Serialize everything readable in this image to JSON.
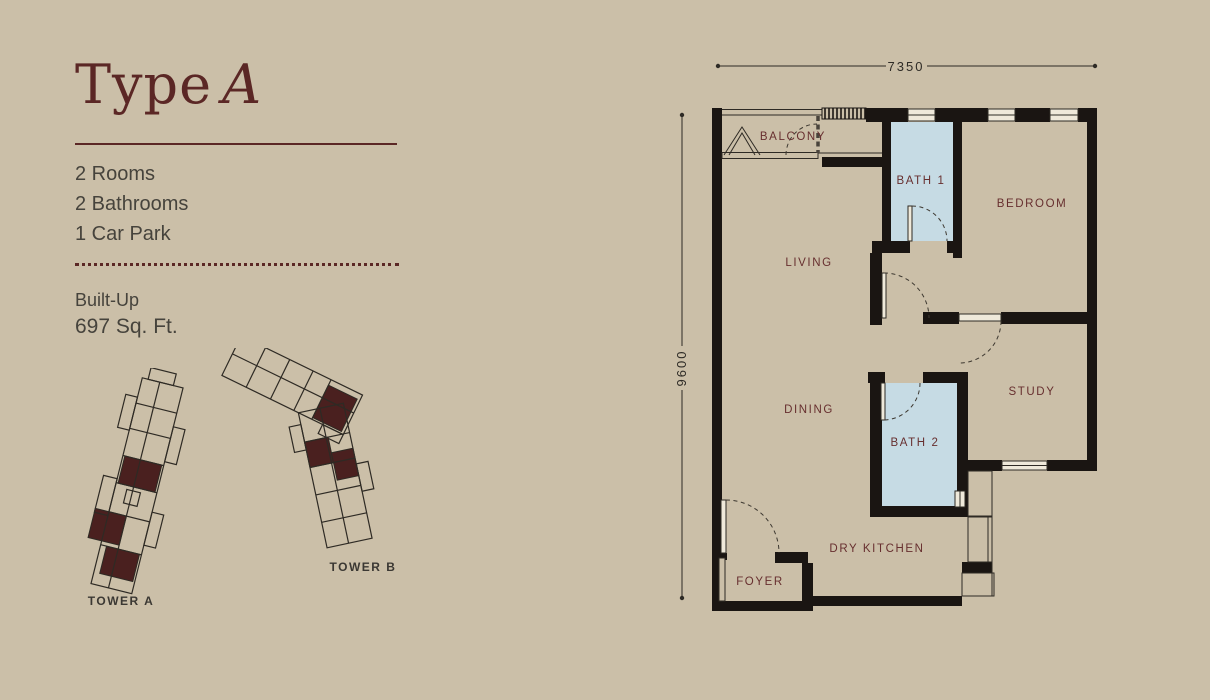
{
  "panel": {
    "title": {
      "regular": "Type",
      "italic": "A"
    },
    "specs": [
      "2 Rooms",
      "2 Bathrooms",
      "1 Car Park"
    ],
    "built_up": {
      "label": "Built-Up",
      "value": "697 Sq. Ft."
    }
  },
  "towers": [
    {
      "label": "TOWER A"
    },
    {
      "label": "TOWER B"
    }
  ],
  "plan": {
    "dimensions": {
      "width": "7350",
      "height": "9600"
    },
    "rooms": {
      "balcony": "BALCONY",
      "bath1": "BATH 1",
      "bedroom": "BEDROOM",
      "living": "LIVING",
      "dining": "DINING",
      "bath2": "BATH 2",
      "study": "STUDY",
      "dry_kitchen": "DRY KITCHEN",
      "foyer": "FOYER"
    }
  },
  "colors": {
    "background": "#cbbfa8",
    "wall": "#1a1512",
    "bath_blue": "#c6dbe4",
    "accent_maroon": "#5b2725",
    "label_maroon": "#672f2f",
    "text_gray": "#46433c",
    "tower_highlight": "#4a201f"
  }
}
